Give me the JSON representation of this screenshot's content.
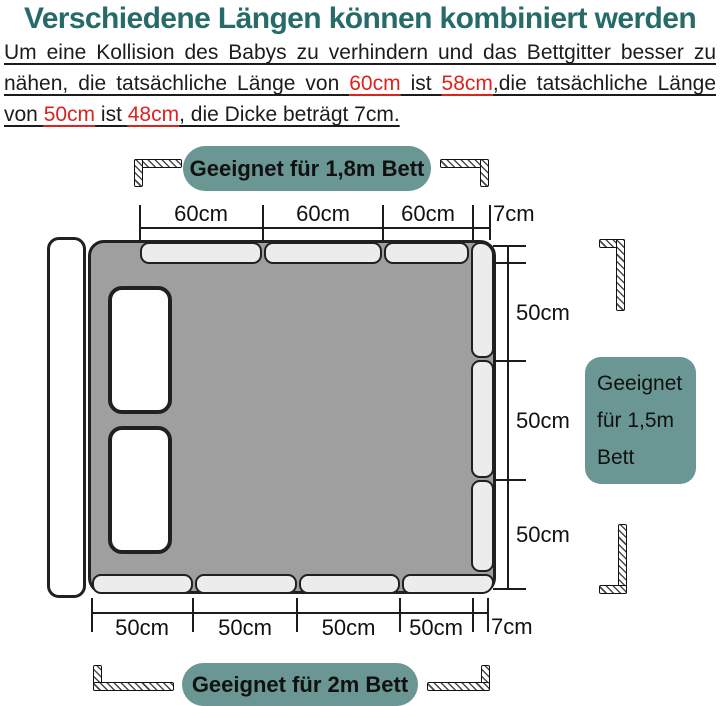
{
  "title": "Verschiedene Längen können kombiniert werden",
  "intro": {
    "l1": "Um eine Kollision des Babys zu verhindern und das Bettgitter besser zu",
    "l2a": "nähen, die tatsächliche Länge von ",
    "l2b": "60cm",
    "l2c": " ist ",
    "l2d": "58cm",
    "l2e": ",die tatsächliche Länge",
    "l3a": "von ",
    "l3b": "50cm",
    "l3c": " ist ",
    "l3d": "48cm",
    "l3e": ", die Dicke beträgt 7cm."
  },
  "badges": {
    "top": "Geeignet für 1,8m Bett",
    "bottom": "Geeignet für 2m Bett",
    "right_lines": [
      "Geeignet",
      "für 1,5m",
      "Bett"
    ]
  },
  "top_dim": {
    "segments": [
      "60cm",
      "60cm",
      "60cm"
    ],
    "end": "7cm"
  },
  "bottom_dim": {
    "segments": [
      "50cm",
      "50cm",
      "50cm",
      "50cm"
    ],
    "end": "7cm"
  },
  "right_dim": {
    "labels": [
      "50cm",
      "50cm",
      "50cm"
    ]
  },
  "colors": {
    "title_teal": "#266b68",
    "accent_teal": "#6a9793",
    "highlight_red": "#dc241f",
    "bed_gray": "#9f9f9f",
    "rail_gray": "#ececec"
  }
}
